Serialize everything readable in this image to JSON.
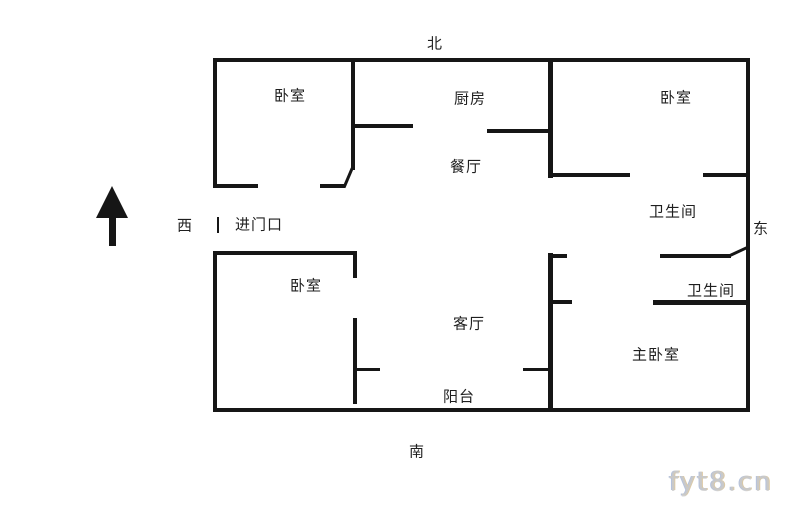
{
  "compass": {
    "north": "北",
    "south": "南",
    "west": "西",
    "east": "东"
  },
  "rooms": {
    "bedroom_nw": "卧室",
    "kitchen": "厨房",
    "bedroom_ne": "卧室",
    "dining": "餐厅",
    "bathroom_upper": "卫生间",
    "entrance": "进门口",
    "bedroom_sw": "卧室",
    "bathroom_lower": "卫生间",
    "living": "客厅",
    "master_bedroom": "主卧室",
    "balcony": "阳台"
  },
  "watermark": "fyt8.cn",
  "colors": {
    "wall": "#161616",
    "text": "#1f1f1f",
    "background": "#ffffff",
    "watermark": "#c9c9c9"
  }
}
